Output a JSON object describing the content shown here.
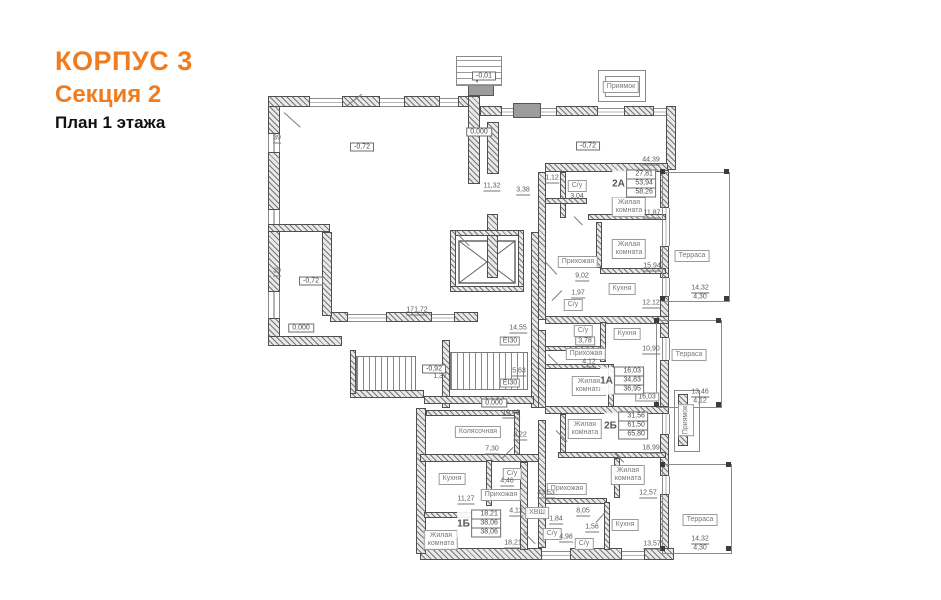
{
  "title": {
    "building": "КОРПУС 3",
    "section": "Секция 2",
    "floor": "План 1 этажа"
  },
  "colors": {
    "accent": "#EF7D1F",
    "ink": "#1a1a1a",
    "drawing": "#5a5a5a"
  },
  "plan": {
    "rooms": [
      {
        "t": "С/у",
        "x": 577,
        "y": 186
      },
      {
        "t": "Жилая\nкомната",
        "x": 629,
        "y": 207
      },
      {
        "t": "Жилая\nкомната",
        "x": 629,
        "y": 249
      },
      {
        "t": "Прихожая",
        "x": 578,
        "y": 262
      },
      {
        "t": "Кухня",
        "x": 622,
        "y": 289
      },
      {
        "t": "С/у",
        "x": 573,
        "y": 305
      },
      {
        "t": "Терраса",
        "x": 692,
        "y": 256
      },
      {
        "t": "С/у",
        "x": 583,
        "y": 331
      },
      {
        "t": "Кухня",
        "x": 627,
        "y": 334
      },
      {
        "t": "Прихожая",
        "x": 586,
        "y": 354
      },
      {
        "t": "Жилая\nкомната",
        "x": 589,
        "y": 386
      },
      {
        "t": "Терраса",
        "x": 689,
        "y": 355
      },
      {
        "t": "Жилая\nкомната",
        "x": 585,
        "y": 429
      },
      {
        "t": "Жилая\nкомната",
        "x": 628,
        "y": 475
      },
      {
        "t": "Прихожая",
        "x": 567,
        "y": 489
      },
      {
        "t": "С/у",
        "x": 552,
        "y": 534
      },
      {
        "t": "С/у",
        "x": 584,
        "y": 544
      },
      {
        "t": "Кухня",
        "x": 625,
        "y": 525
      },
      {
        "t": "Терраса",
        "x": 700,
        "y": 520
      },
      {
        "t": "Колясочная",
        "x": 478,
        "y": 432
      },
      {
        "t": "Кухня",
        "x": 452,
        "y": 479
      },
      {
        "t": "С/у",
        "x": 512,
        "y": 474
      },
      {
        "t": "Прихожая",
        "x": 501,
        "y": 495
      },
      {
        "t": "Жилая\nкомната",
        "x": 441,
        "y": 540
      },
      {
        "t": "ХВШ",
        "x": 537,
        "y": 513
      },
      {
        "t": "Приямок",
        "x": 621,
        "y": 87
      },
      {
        "t": "Приямок",
        "x": 686,
        "y": 420,
        "v": 1
      }
    ],
    "numbers": [
      {
        "t": "44,39",
        "x": 651,
        "y": 161,
        "u": 1
      },
      {
        "t": "11,32",
        "x": 492,
        "y": 187,
        "u": 1
      },
      {
        "t": "3,38",
        "x": 523,
        "y": 191,
        "u": 1
      },
      {
        "t": "1,12",
        "x": 552,
        "y": 179,
        "u": 1
      },
      {
        "t": "3,04",
        "x": 577,
        "y": 197
      },
      {
        "t": "11,87",
        "x": 652,
        "y": 214,
        "u": 1
      },
      {
        "t": "15,94",
        "x": 652,
        "y": 267,
        "u": 1
      },
      {
        "t": "9,02",
        "x": 582,
        "y": 277,
        "u": 1
      },
      {
        "t": "1,97",
        "x": 578,
        "y": 294,
        "u": 1
      },
      {
        "t": "12,12",
        "x": 651,
        "y": 304,
        "u": 1
      },
      {
        "t": "10,90",
        "x": 651,
        "y": 350,
        "u": 1
      },
      {
        "t": "4,12",
        "x": 589,
        "y": 363,
        "u": 1
      },
      {
        "t": "18,99",
        "x": 651,
        "y": 449,
        "u": 1
      },
      {
        "t": "12,57",
        "x": 648,
        "y": 494,
        "u": 1
      },
      {
        "t": "8,05",
        "x": 583,
        "y": 512,
        "u": 1
      },
      {
        "t": "1,84",
        "x": 556,
        "y": 520,
        "u": 1
      },
      {
        "t": "4,98",
        "x": 566,
        "y": 538,
        "u": 1
      },
      {
        "t": "1,56",
        "x": 592,
        "y": 528,
        "u": 1
      },
      {
        "t": "13,57",
        "x": 652,
        "y": 545,
        "u": 1
      },
      {
        "t": "43,53",
        "x": 546,
        "y": 494,
        "u": 1
      },
      {
        "t": "10,49",
        "x": 511,
        "y": 414,
        "u": 1
      },
      {
        "t": "3,22",
        "x": 520,
        "y": 436,
        "u": 1
      },
      {
        "t": "7,30",
        "x": 492,
        "y": 450,
        "u": 1
      },
      {
        "t": "4,46",
        "x": 507,
        "y": 482,
        "u": 1
      },
      {
        "t": "4,12",
        "x": 516,
        "y": 512,
        "u": 1
      },
      {
        "t": "11,27",
        "x": 466,
        "y": 500,
        "u": 1
      },
      {
        "t": "18,21",
        "x": 513,
        "y": 544,
        "u": 1
      },
      {
        "t": "171,72",
        "x": 417,
        "y": 311,
        "u": 1
      },
      {
        "t": "14,55",
        "x": 518,
        "y": 329,
        "u": 1
      },
      {
        "t": "5,63",
        "x": 519,
        "y": 372,
        "u": 1
      },
      {
        "t": "1,37",
        "x": 440,
        "y": 377
      },
      {
        "t": "39",
        "x": 277,
        "y": 139,
        "u": 1
      },
      {
        "t": "39",
        "x": 277,
        "y": 272,
        "u": 1
      }
    ],
    "fracs": [
      {
        "a": "14,32",
        "b": "4,30",
        "x": 700,
        "y": 293
      },
      {
        "a": "13,46",
        "b": "4,12",
        "x": 700,
        "y": 397
      },
      {
        "a": "14,32",
        "b": "4,30",
        "x": 700,
        "y": 544
      }
    ],
    "elevations": [
      {
        "t": "-0,01",
        "x": 484,
        "y": 76
      },
      {
        "t": "0,000",
        "x": 479,
        "y": 132
      },
      {
        "t": "-0,72",
        "x": 362,
        "y": 147
      },
      {
        "t": "-0,72",
        "x": 588,
        "y": 146
      },
      {
        "t": "-0,72",
        "x": 311,
        "y": 281
      },
      {
        "t": "0,000",
        "x": 301,
        "y": 328
      },
      {
        "t": "-0,92",
        "x": 434,
        "y": 369
      },
      {
        "t": "0,000",
        "x": 494,
        "y": 403
      }
    ],
    "tags": [
      {
        "t": "EI30",
        "x": 510,
        "y": 341
      },
      {
        "t": "EI30",
        "x": 510,
        "y": 383
      },
      {
        "t": "3,78",
        "x": 585,
        "y": 341
      },
      {
        "t": "16,03",
        "x": 647,
        "y": 397
      }
    ],
    "stamps": [
      {
        "type": "2А",
        "rows": [
          "27,81",
          "53,94",
          "58,26"
        ],
        "x": 634,
        "y": 184
      },
      {
        "type": "1А",
        "rows": [
          "16,03",
          "34,83",
          "36,95"
        ],
        "x": 622,
        "y": 381
      },
      {
        "type": "2Б",
        "rows": [
          "31,56",
          "61,50",
          "65,80"
        ],
        "x": 626,
        "y": 426
      },
      {
        "type": "1Б",
        "rows": [
          "18,21",
          "38,06",
          "38,06"
        ],
        "x": 479,
        "y": 524
      }
    ]
  }
}
